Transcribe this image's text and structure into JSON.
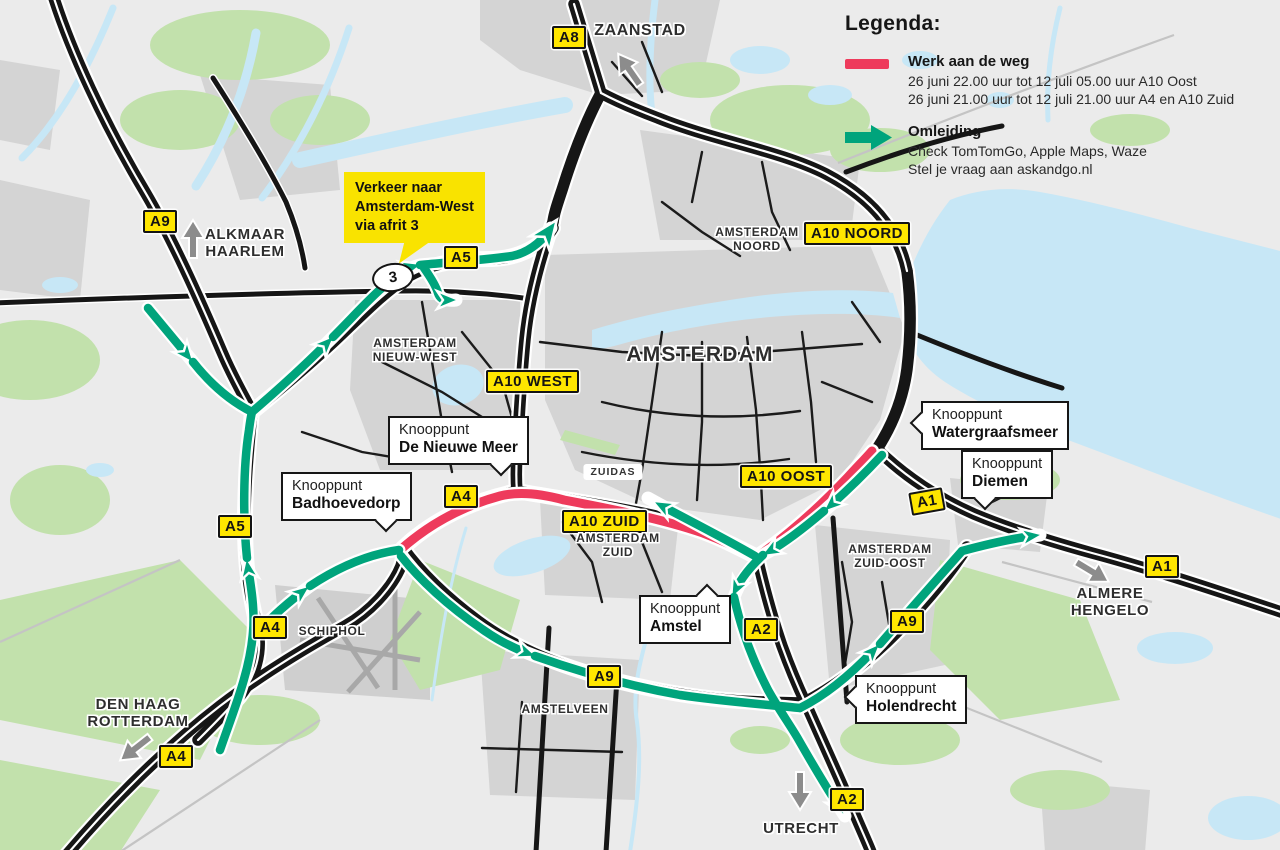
{
  "legend": {
    "title": "Legenda:",
    "roadwork": {
      "label": "Werk aan de weg",
      "line1": "26 juni 22.00 uur tot 12 juli 05.00 uur A10 Oost",
      "line2": "26 juni 21.00 uur tot 12 juli 21.00 uur A4 en A10 Zuid"
    },
    "detour": {
      "label": "Omleiding",
      "line1": "Check TomTomGo, Apple Maps, Waze",
      "line2": "Stel je vraag aan askandgo.nl"
    }
  },
  "detour_callout": {
    "text": "Verkeer naar\nAmsterdam-West\nvia afrit 3",
    "exit_number": "3"
  },
  "road_badges": [
    {
      "id": "a8",
      "label": "A8"
    },
    {
      "id": "a9-nw",
      "label": "A9"
    },
    {
      "id": "a5-afrit",
      "label": "A5"
    },
    {
      "id": "a10-noord",
      "label": "A10 NOORD"
    },
    {
      "id": "a10-west",
      "label": "A10 WEST"
    },
    {
      "id": "a10-oost",
      "label": "A10 OOST"
    },
    {
      "id": "a10-zuid",
      "label": "A10 ZUID"
    },
    {
      "id": "a4-nieuwemeer",
      "label": "A4"
    },
    {
      "id": "a5-west",
      "label": "A5"
    },
    {
      "id": "a4-schiphol",
      "label": "A4"
    },
    {
      "id": "a4-zuidwest",
      "label": "A4"
    },
    {
      "id": "a1-diemen",
      "label": "A1"
    },
    {
      "id": "a1-oost",
      "label": "A1"
    },
    {
      "id": "a2-amstel",
      "label": "A2"
    },
    {
      "id": "a9-gaasperdammer",
      "label": "A9"
    },
    {
      "id": "a9-amstelveen",
      "label": "A9"
    },
    {
      "id": "a2-utrecht",
      "label": "A2"
    }
  ],
  "place_labels": [
    {
      "id": "zaanstad",
      "text": "ZAANSTAD"
    },
    {
      "id": "alkmaar-haarlem",
      "text": "ALKMAAR\nHAARLEM"
    },
    {
      "id": "amsterdam-noord",
      "text": "AMSTERDAM\nNOORD"
    },
    {
      "id": "amsterdam",
      "text": "AMSTERDAM"
    },
    {
      "id": "nieuw-west",
      "text": "AMSTERDAM\nNIEUW-WEST"
    },
    {
      "id": "zuidas",
      "text": "ZUIDAS"
    },
    {
      "id": "amsterdam-zuid",
      "text": "AMSTERDAM\nZUID"
    },
    {
      "id": "zuid-oost",
      "text": "AMSTERDAM\nZUID-OOST"
    },
    {
      "id": "schiphol",
      "text": "SCHIPHOL"
    },
    {
      "id": "amstelveen",
      "text": "AMSTELVEEN"
    },
    {
      "id": "den-haag-rotterdam",
      "text": "DEN HAAG\nROTTERDAM"
    },
    {
      "id": "utrecht",
      "text": "UTRECHT"
    },
    {
      "id": "almere-hengelo",
      "text": "ALMERE\nHENGELO"
    }
  ],
  "junction_labels": [
    {
      "id": "de-nieuwe-meer",
      "prefix": "Knooppunt",
      "name": "De Nieuwe Meer"
    },
    {
      "id": "badhoevedorp",
      "prefix": "Knooppunt",
      "name": "Badhoevedorp"
    },
    {
      "id": "watergraafsmeer",
      "prefix": "Knooppunt",
      "name": "Watergraafsmeer"
    },
    {
      "id": "diemen",
      "prefix": "Knooppunt",
      "name": "Diemen"
    },
    {
      "id": "amstel",
      "prefix": "Knooppunt",
      "name": "Amstel"
    },
    {
      "id": "holendrecht",
      "prefix": "Knooppunt",
      "name": "Holendrecht"
    }
  ],
  "colors": {
    "roadwork_red": "#ee3b5c",
    "detour_green": "#00a47c",
    "badge_yellow": "#ffe600",
    "water_blue": "#c7e7f6",
    "park_green": "#c2e1ac",
    "urban_grey": "#d4d4d4",
    "road_black": "#161616",
    "background": "#ebebeb"
  }
}
